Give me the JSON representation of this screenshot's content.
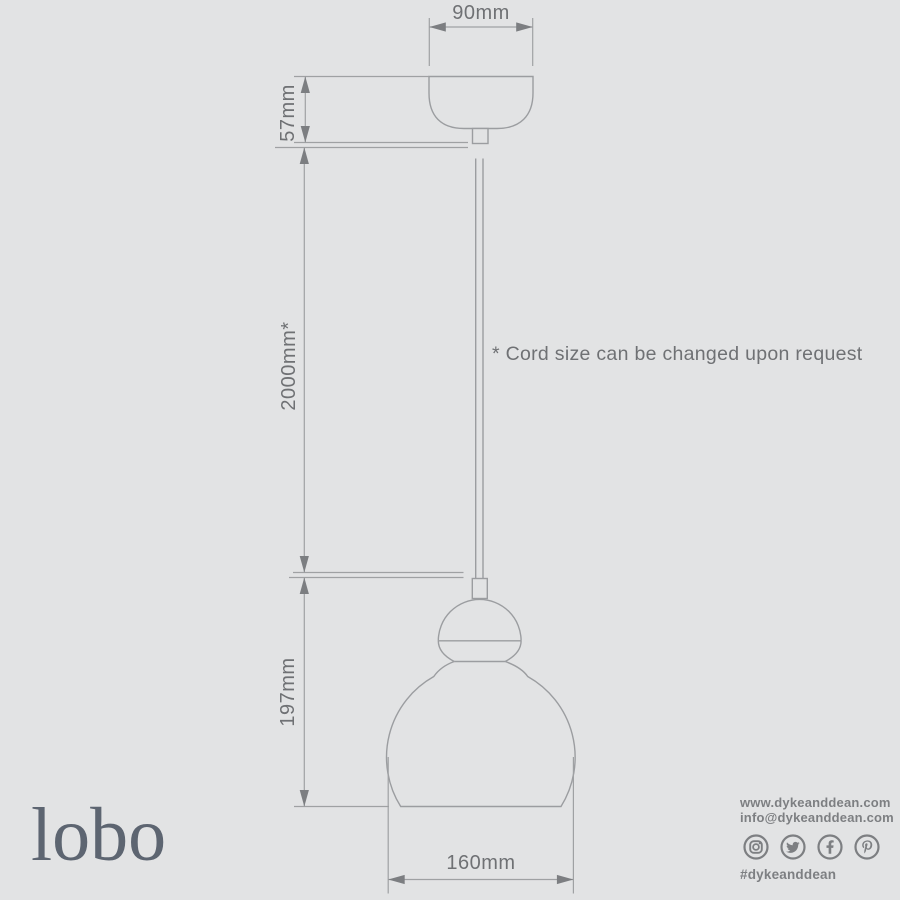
{
  "colors": {
    "background": "#e2e3e4",
    "outline": "#9b9da0",
    "dimension_line": "#9fa1a3",
    "arrow": "#7c7e81",
    "dimension_text": "#6f7174",
    "contact_text": "#7d7f82",
    "logo_text": "#5d6571"
  },
  "diagram": {
    "type": "pendant-light-technical-drawing",
    "dimensions": {
      "canopy_width": "90mm",
      "canopy_height": "57mm",
      "cord_length": "2000mm*",
      "shade_height": "197mm",
      "shade_diameter": "160mm"
    },
    "note": "* Cord size can be changed upon request"
  },
  "branding": {
    "logo": "lobo",
    "website": "www.dykeanddean.com",
    "email": "info@dykeanddean.com",
    "hashtag": "#dykeanddean",
    "social": [
      "instagram",
      "twitter",
      "facebook",
      "pinterest"
    ]
  }
}
